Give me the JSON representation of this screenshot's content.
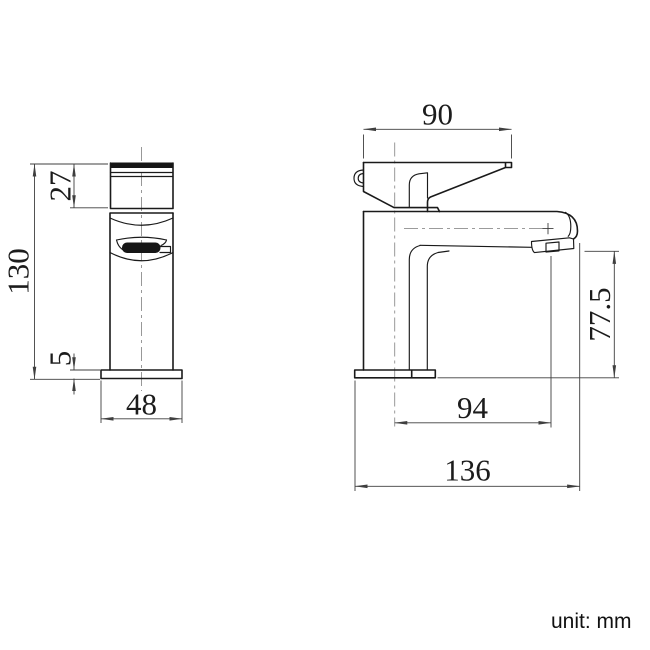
{
  "drawing": {
    "title": "basin mixer tap dimension drawing",
    "unit_note": "unit: mm",
    "colors": {
      "object_line": "#1a1a1a",
      "dimension_line": "#3f3f3f",
      "centerline": "#8d8d8d"
    },
    "views": {
      "front": {
        "name": "front view",
        "dims": {
          "overall_height": "130",
          "handle_height": "27",
          "base_plate_thickness": "5",
          "base_width": "48"
        }
      },
      "side": {
        "name": "side view",
        "dims": {
          "handle_length": "90",
          "spout_outlet_height": "77.5",
          "spout_reach": "94",
          "overall_depth": "136"
        }
      }
    }
  }
}
